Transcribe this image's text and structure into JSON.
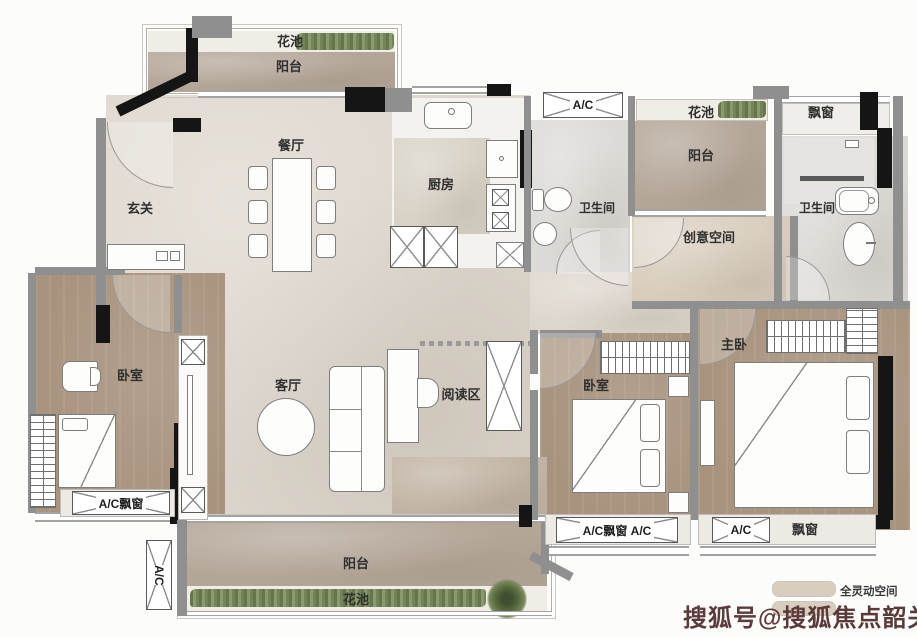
{
  "colors": {
    "floor_main": "#ddd6cc",
    "floor_balcony": "#b3a597",
    "floor_wood": "#a8937e",
    "floor_creative": "#d8cdbd",
    "floor_bath": "#dcdad6",
    "wall_black": "#151515",
    "wall_gray": "#8f8f8f",
    "plant_green": "#7c8c5e",
    "legend_swatch": "#d8cec0",
    "watermark_red": "#5d3a3a"
  },
  "labels": {
    "flower_bed_top_left": "花池",
    "balcony_top_left": "阳台",
    "dining": "餐厅",
    "entry": "玄关",
    "kitchen": "厨房",
    "ac_top": "A/C",
    "flower_bed_top_right": "花池",
    "balcony_top_right": "阳台",
    "bay_window_top_right": "飘窗",
    "bathroom_center": "卫生间",
    "bathroom_right": "卫生间",
    "creative_space": "创意空间",
    "bedroom_left": "卧室",
    "living": "客厅",
    "reading": "阅读区",
    "bedroom_middle": "卧室",
    "master_bedroom": "主卧",
    "ac_bay_bottom_left": "A/C飘窗",
    "ac_left_vertical": "A/C",
    "balcony_bottom": "阳台",
    "flower_bed_bottom": "花池",
    "ac_bay_bottom_mid": "A/C飘窗",
    "ac_bottom_mid": "A/C",
    "ac_bottom_right": "A/C",
    "bay_window_bottom_right": "飘窗"
  },
  "legend": {
    "flex_space": "全灵动空间"
  },
  "watermark": {
    "text": "搜狐号@搜狐焦点韶关站"
  }
}
